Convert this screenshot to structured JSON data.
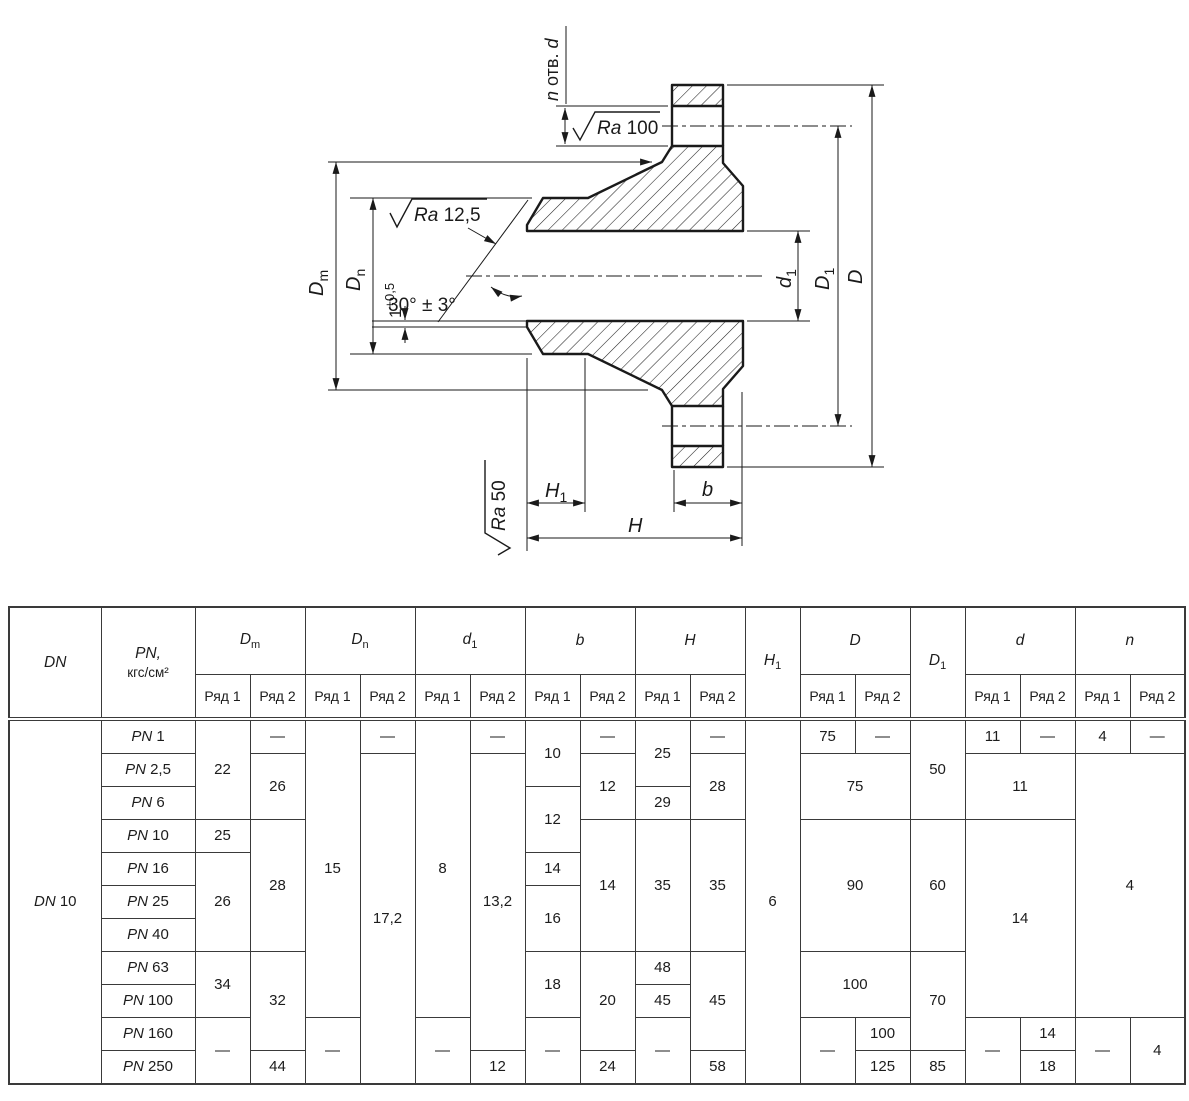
{
  "drawing": {
    "labels": {
      "dm": {
        "base": "D",
        "sub": "m"
      },
      "dn": {
        "base": "D",
        "sub": "n"
      },
      "d1": {
        "base": "d",
        "sub": "1"
      },
      "D1": {
        "base": "D",
        "sub": "1"
      },
      "D": "D",
      "H1": {
        "base": "H",
        "sub": "1"
      },
      "H": "H",
      "b": "b",
      "holes": {
        "n": "n",
        "mid": " отв. ",
        "d": "d"
      },
      "ra100": {
        "sym": "Ra",
        "val": " 100"
      },
      "ra125": {
        "sym": "Ra",
        "val": " 12,5"
      },
      "ra50": {
        "sym": "Ra",
        "val": " 50"
      },
      "angle": "30° ± 3°",
      "land": {
        "base": "1",
        "sup": "+0,5"
      }
    }
  },
  "table": {
    "columns": [
      {
        "label": "DN"
      },
      {
        "label": "PN,",
        "line2": "кгс/см²"
      },
      {
        "label": "D",
        "sub": "m",
        "split": true
      },
      {
        "label": "D",
        "sub": "n",
        "split": true
      },
      {
        "label": "d",
        "sub": "1",
        "split": true
      },
      {
        "label": "b",
        "split": true
      },
      {
        "label": "H",
        "split": true
      },
      {
        "label": "H",
        "sub": "1"
      },
      {
        "label": "D",
        "split": true
      },
      {
        "label": "D",
        "sub": "1"
      },
      {
        "label": "d",
        "split": true
      },
      {
        "label": "n",
        "split": true
      }
    ],
    "subheaders": [
      "Ряд 1",
      "Ряд 2"
    ],
    "body": [
      [
        {
          "sym": "DN",
          "v": "10",
          "rs": 11
        },
        {
          "sym": "PN",
          "v": "1"
        },
        {
          "v": "22",
          "rs": 3
        },
        {
          "v": "—"
        },
        {
          "v": "15",
          "rs": 9
        },
        {
          "v": "—"
        },
        {
          "v": "8",
          "rs": 9
        },
        {
          "v": "—"
        },
        {
          "v": "10",
          "rs": 2
        },
        {
          "v": "—"
        },
        {
          "v": "25",
          "rs": 2
        },
        {
          "v": "—"
        },
        {
          "v": "6",
          "rs": 11
        },
        {
          "v": "75"
        },
        {
          "v": "—"
        },
        {
          "v": "50",
          "rs": 3
        },
        {
          "v": "11"
        },
        {
          "v": "—"
        },
        {
          "v": "4"
        },
        {
          "v": "—"
        }
      ],
      [
        {
          "sym": "PN",
          "v": "2,5"
        },
        {
          "v": "26",
          "rs": 2
        },
        {
          "v": "17,2",
          "rs": 10
        },
        {
          "v": "13,2",
          "rs": 9
        },
        {
          "v": "12",
          "rs": 2
        },
        {
          "v": "28",
          "rs": 2
        },
        {
          "v": "75",
          "rs": 2,
          "cs": 2
        },
        {
          "v": "11",
          "rs": 2,
          "cs": 2
        },
        {
          "v": "4",
          "rs": 8,
          "cs": 2
        }
      ],
      [
        {
          "sym": "PN",
          "v": "6"
        },
        {
          "v": "12",
          "rs": 2
        },
        {
          "v": "29"
        }
      ],
      [
        {
          "sym": "PN",
          "v": "10"
        },
        {
          "v": "25"
        },
        {
          "v": "28",
          "rs": 4
        },
        {
          "v": "14",
          "rs": 4
        },
        {
          "v": "35",
          "rs": 4
        },
        {
          "v": "35",
          "rs": 4
        },
        {
          "v": "90",
          "rs": 4,
          "cs": 2
        },
        {
          "v": "60",
          "rs": 4
        },
        {
          "v": "14",
          "rs": 6,
          "cs": 2
        }
      ],
      [
        {
          "sym": "PN",
          "v": "16"
        },
        {
          "v": "26",
          "rs": 3
        },
        {
          "v": "14"
        }
      ],
      [
        {
          "sym": "PN",
          "v": "25"
        },
        {
          "v": "16",
          "rs": 2
        }
      ],
      [
        {
          "sym": "PN",
          "v": "40"
        }
      ],
      [
        {
          "sym": "PN",
          "v": "63"
        },
        {
          "v": "34",
          "rs": 2
        },
        {
          "v": "32",
          "rs": 3
        },
        {
          "v": "18",
          "rs": 2
        },
        {
          "v": "20",
          "rs": 3
        },
        {
          "v": "48"
        },
        {
          "v": "45",
          "rs": 3
        },
        {
          "v": "100",
          "rs": 2,
          "cs": 2
        },
        {
          "v": "70",
          "rs": 3
        }
      ],
      [
        {
          "sym": "PN",
          "v": "100"
        },
        {
          "v": "45"
        }
      ],
      [
        {
          "sym": "PN",
          "v": "160"
        },
        {
          "v": "—",
          "rs": 2
        },
        {
          "v": "—",
          "rs": 2
        },
        {
          "v": "—",
          "rs": 2
        },
        {
          "v": "—",
          "rs": 2
        },
        {
          "v": "—",
          "rs": 2
        },
        {
          "v": "—",
          "rs": 2
        },
        {
          "v": "100"
        },
        {
          "v": "—",
          "rs": 2
        },
        {
          "v": "14"
        },
        {
          "v": "—",
          "rs": 2
        },
        {
          "v": "4",
          "rs": 2
        }
      ],
      [
        {
          "sym": "PN",
          "v": "250"
        },
        {
          "v": "44"
        },
        {
          "v": "12"
        },
        {
          "v": "24"
        },
        {
          "v": "58"
        },
        {
          "v": "125"
        },
        {
          "v": "85"
        },
        {
          "v": "18"
        }
      ]
    ]
  }
}
